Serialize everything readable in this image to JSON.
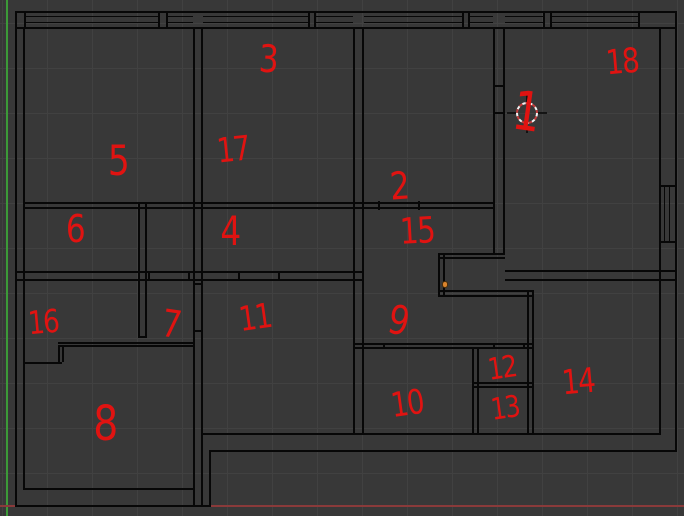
{
  "scene": {
    "background": "#383838",
    "grid_color": "#414141",
    "grid_step": 45,
    "grid_offset_x": 2,
    "grid_offset_y": 23,
    "wall_color": "#070707",
    "annotation_color": "#e01311",
    "axis_y_color": "#3c9a38",
    "axis_x_color": "#8a3a3a",
    "axis_y_x": 6,
    "axis_x_y": 505,
    "selected_vertex_color": "#d9842e",
    "selected_vertex_border": "#4a2e08",
    "cursor_red": "#c23c3c",
    "cursor_white": "#f2f2f2"
  },
  "room_labels": [
    {
      "label": "1",
      "x": 526,
      "y": 112,
      "rot": 8,
      "size": 54
    },
    {
      "label": "2",
      "x": 399,
      "y": 186,
      "rot": -4,
      "size": 38
    },
    {
      "label": "3",
      "x": 268,
      "y": 59,
      "rot": 3,
      "size": 38
    },
    {
      "label": "4",
      "x": 230,
      "y": 232,
      "rot": 0,
      "size": 40
    },
    {
      "label": "5",
      "x": 118,
      "y": 161,
      "rot": 0,
      "size": 42
    },
    {
      "label": "6",
      "x": 75,
      "y": 229,
      "rot": 0,
      "size": 38
    },
    {
      "label": "7",
      "x": 171,
      "y": 324,
      "rot": 8,
      "size": 38
    },
    {
      "label": "8",
      "x": 105,
      "y": 424,
      "rot": 0,
      "size": 48
    },
    {
      "label": "9",
      "x": 398,
      "y": 321,
      "rot": 12,
      "size": 40
    },
    {
      "label": "10",
      "x": 407,
      "y": 404,
      "rot": -8,
      "size": 34
    },
    {
      "label": "11",
      "x": 255,
      "y": 318,
      "rot": -8,
      "size": 34
    },
    {
      "label": "12",
      "x": 502,
      "y": 369,
      "rot": -8,
      "size": 30
    },
    {
      "label": "13",
      "x": 505,
      "y": 409,
      "rot": -8,
      "size": 30
    },
    {
      "label": "14",
      "x": 578,
      "y": 382,
      "rot": -5,
      "size": 34
    },
    {
      "label": "15",
      "x": 417,
      "y": 232,
      "rot": -3,
      "size": 36
    },
    {
      "label": "16",
      "x": 43,
      "y": 322,
      "rot": -5,
      "size": 32
    },
    {
      "label": "17",
      "x": 233,
      "y": 150,
      "rot": -6,
      "size": 34
    },
    {
      "label": "18",
      "x": 622,
      "y": 62,
      "rot": -5,
      "size": 34
    }
  ],
  "cursor_3d": {
    "x": 527,
    "y": 113,
    "radius": 10
  },
  "selected_vertex": {
    "x": 445,
    "y": 284
  },
  "floorplan": {
    "segments": [
      {
        "x": 15,
        "y": 11,
        "w": 662,
        "h": 2
      },
      {
        "x": 15,
        "y": 27,
        "w": 662,
        "h": 2
      },
      {
        "x": 24,
        "y": 16,
        "w": 136,
        "h": 1
      },
      {
        "x": 24,
        "y": 22,
        "w": 136,
        "h": 1
      },
      {
        "x": 166,
        "y": 16,
        "w": 27,
        "h": 1
      },
      {
        "x": 166,
        "y": 22,
        "w": 27,
        "h": 1
      },
      {
        "x": 203,
        "y": 16,
        "w": 105,
        "h": 1
      },
      {
        "x": 203,
        "y": 22,
        "w": 105,
        "h": 1
      },
      {
        "x": 314,
        "y": 16,
        "w": 39,
        "h": 1
      },
      {
        "x": 314,
        "y": 22,
        "w": 39,
        "h": 1
      },
      {
        "x": 364,
        "y": 16,
        "w": 98,
        "h": 1
      },
      {
        "x": 364,
        "y": 22,
        "w": 98,
        "h": 1
      },
      {
        "x": 468,
        "y": 16,
        "w": 25,
        "h": 1
      },
      {
        "x": 468,
        "y": 22,
        "w": 25,
        "h": 1
      },
      {
        "x": 505,
        "y": 16,
        "w": 40,
        "h": 1
      },
      {
        "x": 505,
        "y": 22,
        "w": 40,
        "h": 1
      },
      {
        "x": 550,
        "y": 16,
        "w": 88,
        "h": 1
      },
      {
        "x": 550,
        "y": 22,
        "w": 88,
        "h": 1
      },
      {
        "x": 24,
        "y": 11,
        "w": 2,
        "h": 16
      },
      {
        "x": 158,
        "y": 11,
        "w": 2,
        "h": 16
      },
      {
        "x": 166,
        "y": 11,
        "w": 2,
        "h": 16
      },
      {
        "x": 308,
        "y": 11,
        "w": 2,
        "h": 16
      },
      {
        "x": 314,
        "y": 11,
        "w": 2,
        "h": 16
      },
      {
        "x": 462,
        "y": 11,
        "w": 2,
        "h": 16
      },
      {
        "x": 468,
        "y": 11,
        "w": 2,
        "h": 16
      },
      {
        "x": 543,
        "y": 11,
        "w": 2,
        "h": 16
      },
      {
        "x": 550,
        "y": 11,
        "w": 2,
        "h": 16
      },
      {
        "x": 638,
        "y": 11,
        "w": 2,
        "h": 16
      },
      {
        "x": 15,
        "y": 11,
        "w": 2,
        "h": 496
      },
      {
        "x": 23,
        "y": 27,
        "w": 2,
        "h": 463
      },
      {
        "x": 675,
        "y": 11,
        "w": 2,
        "h": 441
      },
      {
        "x": 659,
        "y": 27,
        "w": 2,
        "h": 408
      },
      {
        "x": 659,
        "y": 185,
        "w": 18,
        "h": 2
      },
      {
        "x": 659,
        "y": 241,
        "w": 18,
        "h": 2
      },
      {
        "x": 664,
        "y": 187,
        "w": 1,
        "h": 54
      },
      {
        "x": 669,
        "y": 187,
        "w": 1,
        "h": 54
      },
      {
        "x": 201,
        "y": 433,
        "w": 460,
        "h": 2
      },
      {
        "x": 209,
        "y": 450,
        "w": 468,
        "h": 2
      },
      {
        "x": 23,
        "y": 488,
        "w": 172,
        "h": 2
      },
      {
        "x": 15,
        "y": 505,
        "w": 196,
        "h": 2
      },
      {
        "x": 209,
        "y": 450,
        "w": 2,
        "h": 57
      },
      {
        "x": 193,
        "y": 27,
        "w": 2,
        "h": 480
      },
      {
        "x": 201,
        "y": 27,
        "w": 2,
        "h": 480
      },
      {
        "x": 193,
        "y": 283,
        "w": 10,
        "h": 2
      },
      {
        "x": 193,
        "y": 330,
        "w": 10,
        "h": 2
      },
      {
        "x": 353,
        "y": 27,
        "w": 2,
        "h": 408
      },
      {
        "x": 362,
        "y": 27,
        "w": 2,
        "h": 408
      },
      {
        "x": 493,
        "y": 27,
        "w": 2,
        "h": 227
      },
      {
        "x": 503,
        "y": 27,
        "w": 2,
        "h": 227
      },
      {
        "x": 495,
        "y": 85,
        "w": 8,
        "h": 2
      },
      {
        "x": 495,
        "y": 112,
        "w": 8,
        "h": 2
      },
      {
        "x": 23,
        "y": 202,
        "w": 470,
        "h": 2
      },
      {
        "x": 23,
        "y": 207,
        "w": 470,
        "h": 2
      },
      {
        "x": 378,
        "y": 201,
        "w": 2,
        "h": 9
      },
      {
        "x": 418,
        "y": 201,
        "w": 2,
        "h": 9
      },
      {
        "x": 15,
        "y": 271,
        "w": 349,
        "h": 2
      },
      {
        "x": 15,
        "y": 279,
        "w": 349,
        "h": 2
      },
      {
        "x": 148,
        "y": 271,
        "w": 2,
        "h": 10
      },
      {
        "x": 188,
        "y": 271,
        "w": 2,
        "h": 10
      },
      {
        "x": 238,
        "y": 271,
        "w": 2,
        "h": 10
      },
      {
        "x": 278,
        "y": 271,
        "w": 2,
        "h": 10
      },
      {
        "x": 505,
        "y": 270,
        "w": 172,
        "h": 2
      },
      {
        "x": 505,
        "y": 279,
        "w": 172,
        "h": 2
      },
      {
        "x": 138,
        "y": 203,
        "w": 2,
        "h": 135
      },
      {
        "x": 145,
        "y": 203,
        "w": 2,
        "h": 135
      },
      {
        "x": 138,
        "y": 336,
        "w": 9,
        "h": 2
      },
      {
        "x": 58,
        "y": 342,
        "w": 137,
        "h": 2
      },
      {
        "x": 58,
        "y": 345,
        "w": 137,
        "h": 2
      },
      {
        "x": 58,
        "y": 347,
        "w": 2,
        "h": 15
      },
      {
        "x": 62,
        "y": 347,
        "w": 2,
        "h": 15
      },
      {
        "x": 23,
        "y": 362,
        "w": 39,
        "h": 2
      },
      {
        "x": 438,
        "y": 253,
        "w": 67,
        "h": 2
      },
      {
        "x": 438,
        "y": 257,
        "w": 67,
        "h": 2
      },
      {
        "x": 438,
        "y": 253,
        "w": 2,
        "h": 42
      },
      {
        "x": 443,
        "y": 253,
        "w": 2,
        "h": 42
      },
      {
        "x": 438,
        "y": 290,
        "w": 96,
        "h": 2
      },
      {
        "x": 438,
        "y": 295,
        "w": 96,
        "h": 2
      },
      {
        "x": 527,
        "y": 290,
        "w": 2,
        "h": 145
      },
      {
        "x": 532,
        "y": 290,
        "w": 2,
        "h": 145
      },
      {
        "x": 353,
        "y": 343,
        "w": 181,
        "h": 2
      },
      {
        "x": 353,
        "y": 347,
        "w": 181,
        "h": 2
      },
      {
        "x": 383,
        "y": 343,
        "w": 2,
        "h": 6
      },
      {
        "x": 493,
        "y": 343,
        "w": 2,
        "h": 6
      },
      {
        "x": 523,
        "y": 343,
        "w": 2,
        "h": 6
      },
      {
        "x": 472,
        "y": 347,
        "w": 2,
        "h": 88
      },
      {
        "x": 477,
        "y": 347,
        "w": 2,
        "h": 88
      },
      {
        "x": 472,
        "y": 382,
        "w": 60,
        "h": 2
      },
      {
        "x": 472,
        "y": 386,
        "w": 60,
        "h": 2
      }
    ]
  }
}
